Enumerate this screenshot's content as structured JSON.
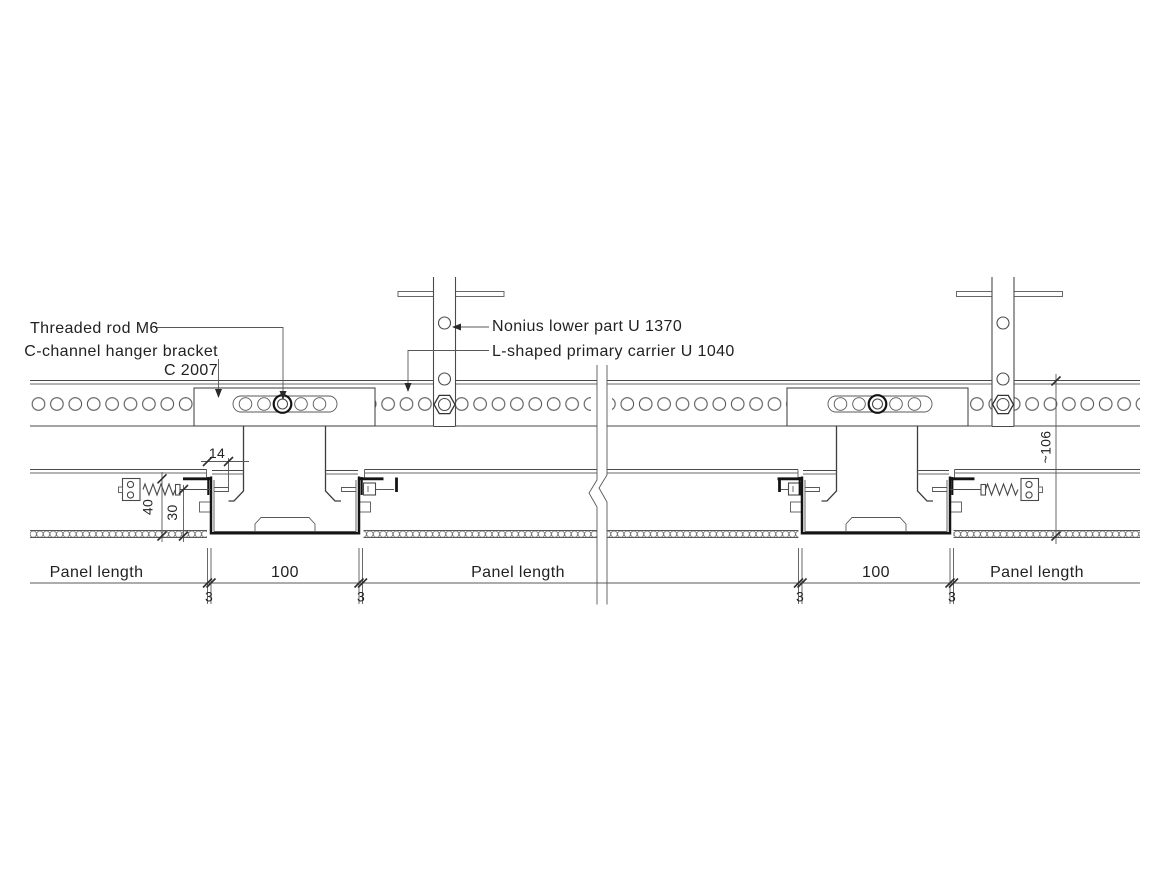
{
  "annotations": {
    "threaded_rod": "Threaded rod M6",
    "hanger_bracket_line1": "C-channel hanger bracket",
    "hanger_bracket_line2": "C 2007",
    "nonius_lower_part": "Nonius lower part U 1370",
    "primary_carrier": "L-shaped primary carrier U 1040"
  },
  "dimensions": {
    "edge_offset": "14",
    "height_40": "40",
    "recess_30": "30",
    "suspension_height": "~106",
    "channel_width": "100",
    "joint_gap": "3",
    "panel_length_label": "Panel length"
  },
  "colors": {
    "background": "#ffffff",
    "line": "#4a4a4a",
    "bold_line": "#141414",
    "text": "#222222"
  }
}
